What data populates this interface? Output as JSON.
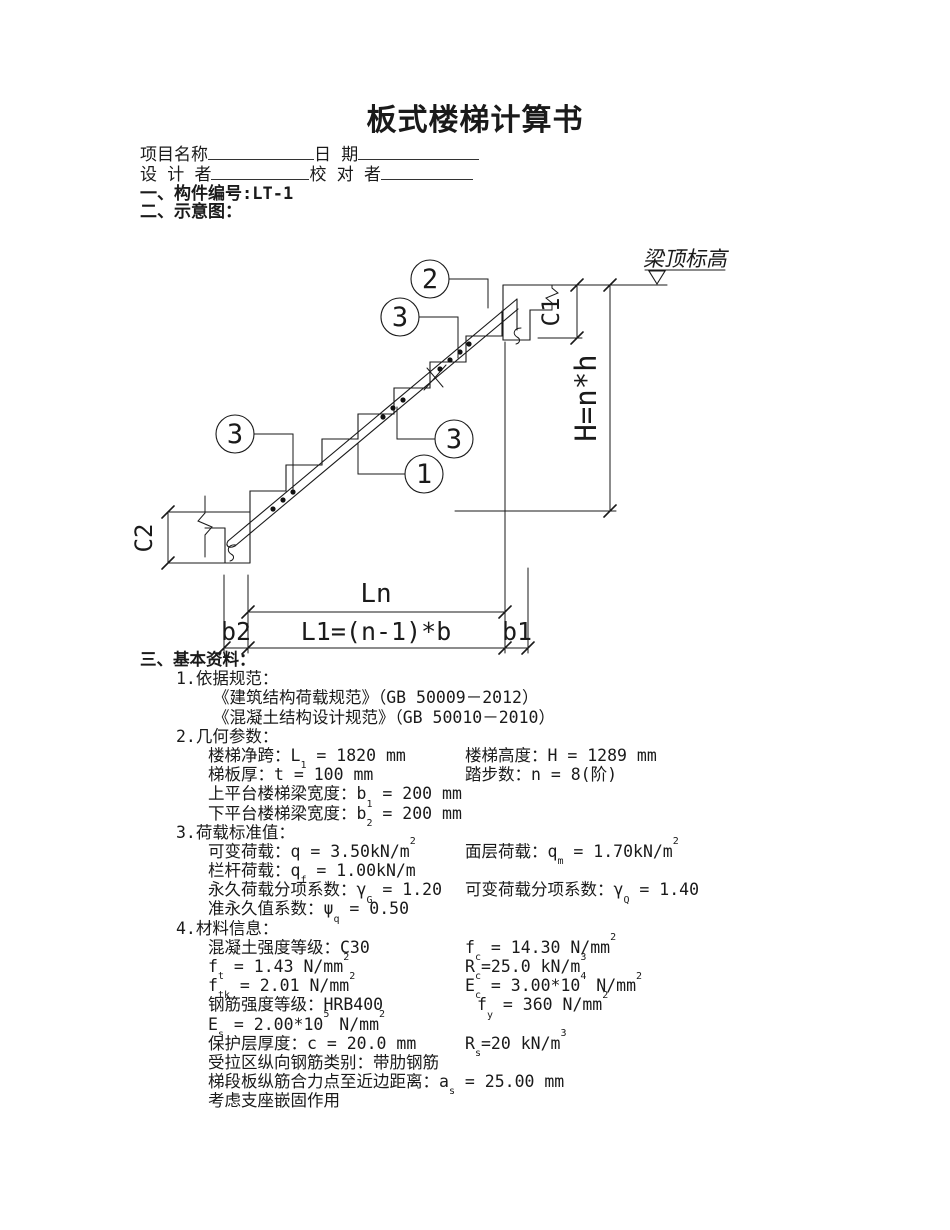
{
  "colors": {
    "paper": "#ffffff",
    "ink": "#1a1a1a"
  },
  "title": "板式楼梯计算书",
  "form": {
    "project_label": "项目名称",
    "date_label": "日 期",
    "designer_label": "设 计 者",
    "checker_label": "校 对 者"
  },
  "sections": {
    "component": "一、构件编号:LT-1",
    "sketch": "二、示意图：",
    "basic": "三、基本资料："
  },
  "diagram": {
    "beam_top_label": "梁顶标高",
    "height_formula": "H=n*h",
    "c1_label": "C1",
    "c2_label": "C2",
    "ln_label": "Ln",
    "l1_formula": "L1=(n-1)*b",
    "b1_label": "b1",
    "b2_label": "b2",
    "callout_main_bar": "1",
    "callout_top_bar": "2",
    "callout_dist_bar": "3"
  },
  "basic_info": {
    "items": [
      {
        "title": "1.依据规范：",
        "rows": [
          {
            "cls": "code",
            "l": [
              "《建筑结构荷载规范》（GB 50009－2012）"
            ]
          },
          {
            "cls": "code",
            "l": [
              "《混凝土结构设计规范》（GB 50010－2010）"
            ]
          }
        ]
      },
      {
        "title": "2.几何参数：",
        "rows": [
          {
            "l": [
              "楼梯净跨：L",
              "_1",
              " = 1820 mm"
            ],
            "r": [
              "楼梯高度：H = 1289 mm"
            ]
          },
          {
            "l": [
              "梯板厚：t = 100 mm"
            ],
            "r": [
              "踏步数：n = 8(阶)"
            ]
          },
          {
            "l": [
              "上平台楼梯梁宽度：b",
              "_1",
              " = 200 mm"
            ]
          },
          {
            "l": [
              "下平台楼梯梁宽度：b",
              "_2",
              " = 200 mm"
            ]
          }
        ]
      },
      {
        "title": "3.荷载标准值：",
        "rows": [
          {
            "l": [
              "可变荷载：q = 3.50kN/m",
              "^2"
            ],
            "r": [
              "面层荷载：q",
              "_m",
              " = 1.70kN/m",
              "^2"
            ]
          },
          {
            "l": [
              "栏杆荷载：q",
              "_f",
              " = 1.00kN/m"
            ]
          },
          {
            "l": [
              "永久荷载分项系数：γ",
              "_G",
              " = 1.20"
            ],
            "r": [
              "可变荷载分项系数：γ",
              "_Q",
              " = 1.40"
            ]
          },
          {
            "l": [
              "准永久值系数：ψ",
              "_q",
              " = 0.50"
            ]
          }
        ]
      },
      {
        "title": "4.材料信息：",
        "rows": [
          {
            "l": [
              "混凝土强度等级：C30"
            ],
            "r": [
              "f",
              "_c",
              " = 14.30 N/mm",
              "^2"
            ]
          },
          {
            "l": [
              "f",
              "_t",
              " = 1.43 N/mm",
              "^2"
            ],
            "r": [
              "R",
              "_c",
              "=25.0 kN/m",
              "^3"
            ]
          },
          {
            "l": [
              "f",
              "_tk",
              " = 2.01 N/mm",
              "^2"
            ],
            "r": [
              "E",
              "_c",
              " = 3.00*10",
              "^4",
              " N/mm",
              "^2"
            ]
          },
          {
            "l": [
              "钢筋强度等级：HRB400"
            ],
            "r": [
              "f",
              "_y",
              " = 360 N/mm",
              "^2"
            ],
            "rpad": true
          },
          {
            "l": [
              "E",
              "_s",
              " = 2.00*10",
              "^5",
              " N/mm",
              "^2"
            ]
          },
          {
            "l": [
              "保护层厚度：c = 20.0 mm"
            ],
            "r": [
              "R",
              "_s",
              "=20 kN/m",
              "^3"
            ]
          },
          {
            "l": [
              "受拉区纵向钢筋类别：带肋钢筋"
            ]
          },
          {
            "l": [
              "梯段板纵筋合力点至近边距离：a",
              "_s",
              " = 25.00 mm"
            ]
          },
          {
            "l": [
              "考虑支座嵌固作用"
            ]
          }
        ]
      }
    ]
  }
}
